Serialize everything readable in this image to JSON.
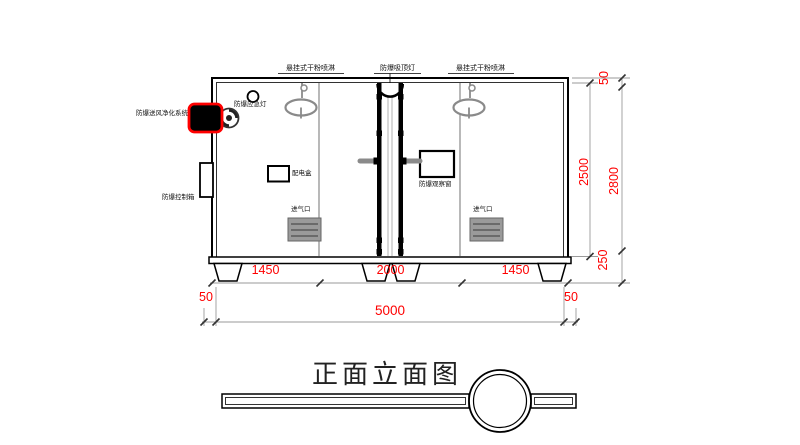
{
  "drawing": {
    "title": "正面立面图",
    "labels": {
      "sprinkler_left": "悬挂式干粉喷淋",
      "ceiling_lamp": "防爆吸顶灯",
      "sprinkler_right": "悬挂式干粉喷淋",
      "emergency_lamp": "防爆应急灯",
      "purification_system": "防爆送风净化系统",
      "control_box": "防爆控制箱",
      "power_box": "配电盒",
      "observation_window": "防爆观察窗",
      "air_inlet_left": "进气口",
      "air_inlet_right": "进气口"
    },
    "dimensions": {
      "bottom_segments": [
        "1450",
        "2000",
        "1450"
      ],
      "bottom_left_offset": "50",
      "bottom_total": "5000",
      "bottom_right_offset": "50",
      "right_inner_height": "2500",
      "right_top_offset": "50",
      "right_total_height": "2800",
      "right_bottom_offset": "250"
    },
    "colors": {
      "dimension_text": "#fe0000",
      "highlight_box": "#ff0000",
      "main_line": "#000000",
      "secondary_line": "#8a8a8a"
    }
  }
}
